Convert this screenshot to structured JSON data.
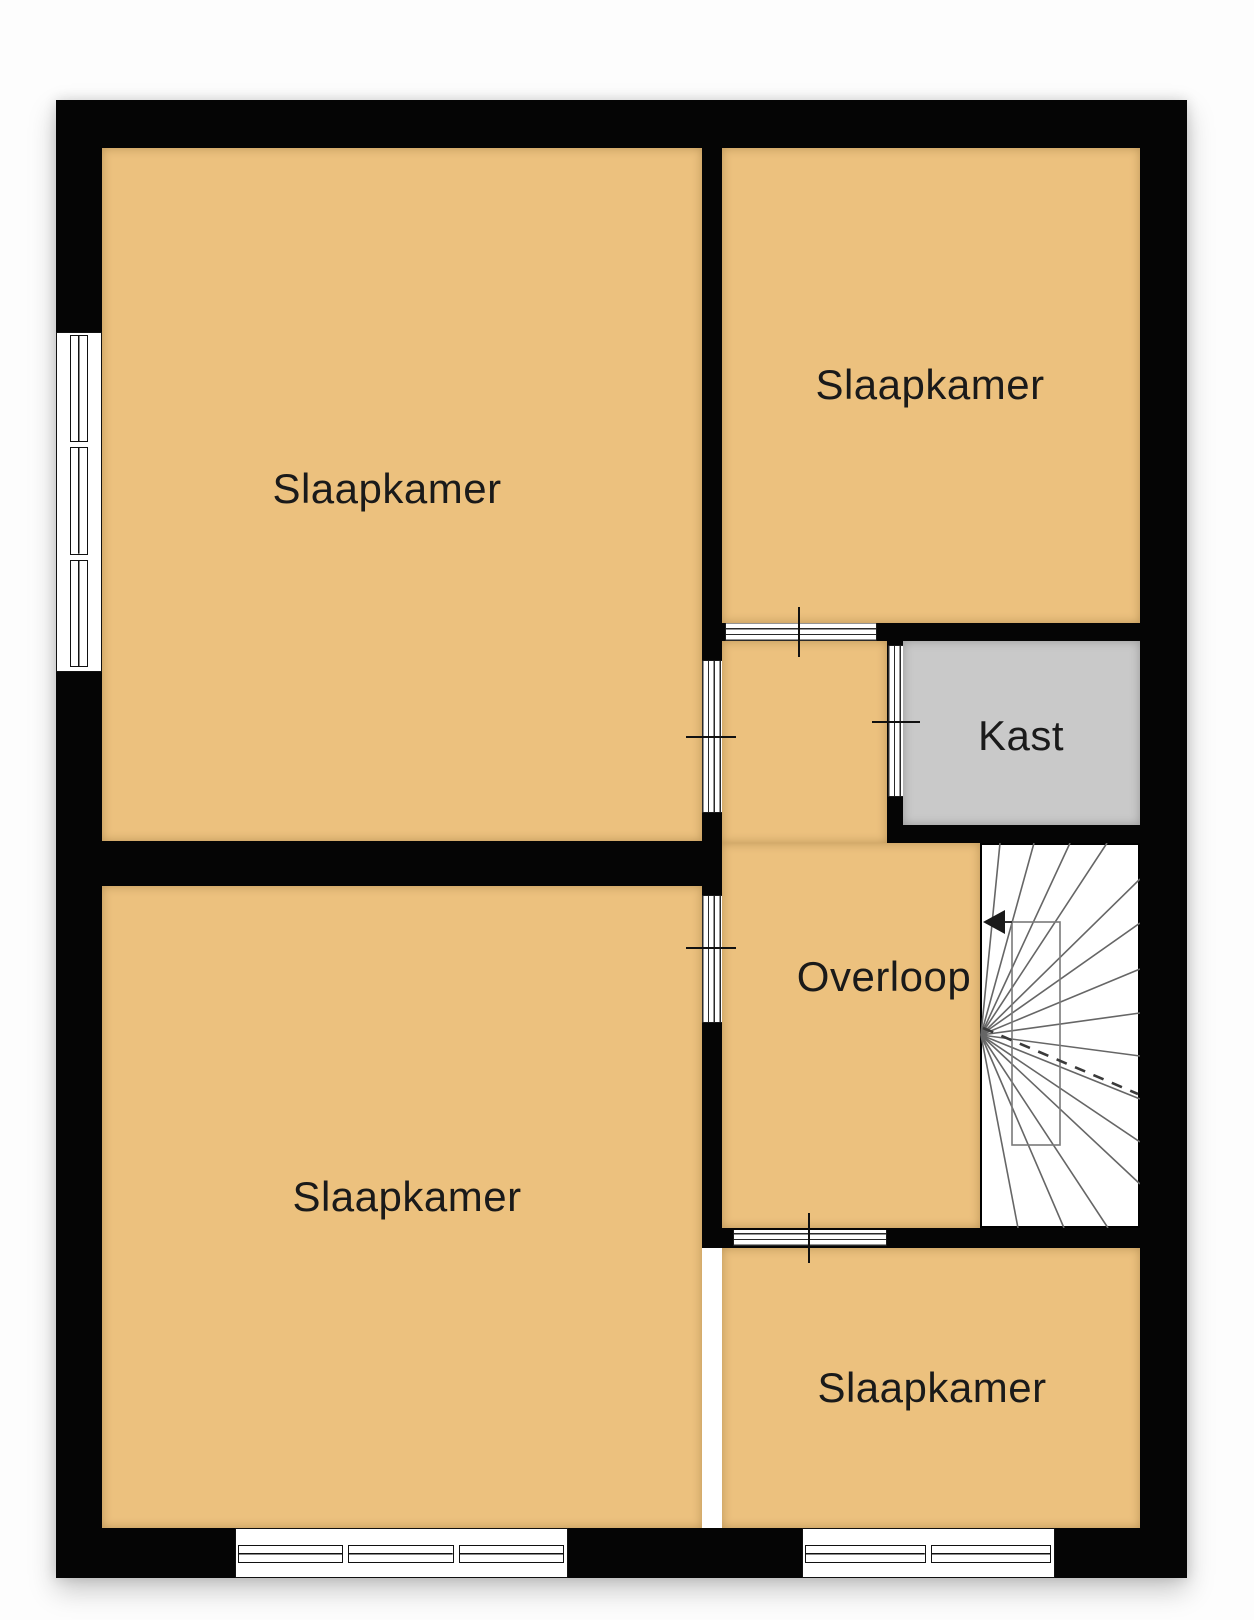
{
  "floorplan": {
    "rooms": [
      {
        "id": "bedroom-top-left",
        "label": "Slaapkamer"
      },
      {
        "id": "bedroom-top-right",
        "label": "Slaapkamer"
      },
      {
        "id": "bedroom-bottom-left",
        "label": "Slaapkamer"
      },
      {
        "id": "bedroom-bottom-right",
        "label": "Slaapkamer"
      },
      {
        "id": "closet",
        "label": "Kast"
      },
      {
        "id": "landing",
        "label": "Overloop"
      }
    ],
    "colors": {
      "floor": "#ecc17e",
      "closet": "#c9c9c9",
      "wall": "#050505",
      "stair_lines": "#666666",
      "text": "#1a1a1a",
      "background": "#fdfdfd"
    }
  }
}
